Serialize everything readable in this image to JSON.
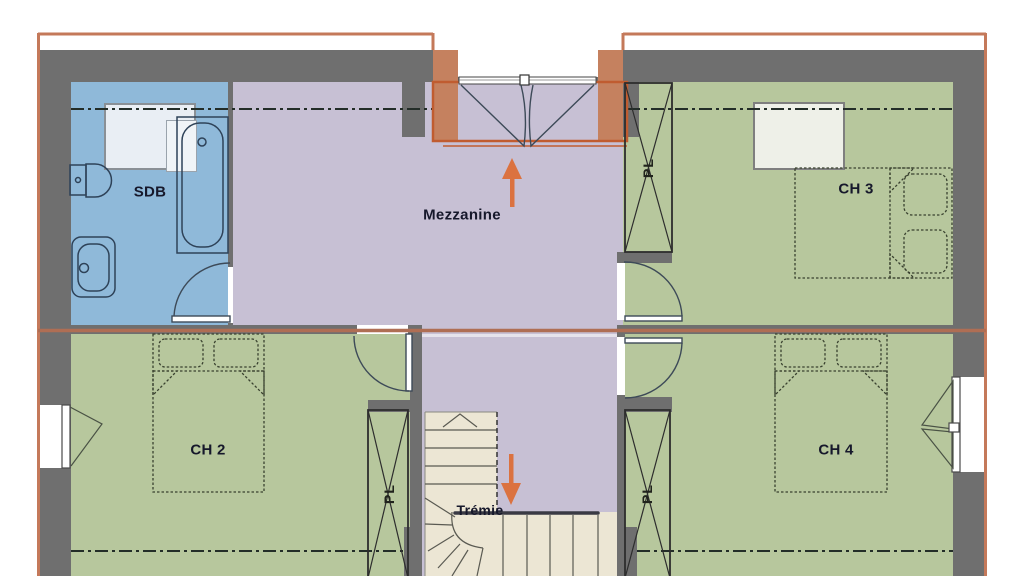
{
  "plan": {
    "type": "architectural-floor-plan-upper-storey",
    "labels": {
      "bathroom": "SDB",
      "mezzanine": "Mezzanine",
      "bedroom_2": "CH 2",
      "bedroom_3": "CH 3",
      "bedroom_4": "CH 4",
      "stair_opening": "Trémie",
      "closet": "PL"
    },
    "annotations": {
      "arrow_up": "up-arrow-into-mezzanine",
      "arrow_down": "down-arrow-to-stairs"
    },
    "colors": {
      "bathroom_fill": "#8fb9d9",
      "mezzanine_fill": "#c7c0d4",
      "bedroom_fill": "#b7c79d",
      "stairs_fill": "#ece6d4",
      "wall_fill": "#6f6f6f",
      "roof_outline": "#c4795a",
      "ridge_line": "#af6e54",
      "door_recess_fill": "#c5815f",
      "highlight_outline": "#c05c30",
      "arrow": "#db7240",
      "roof_window_fill": "#eef0e8",
      "axis_dashdot": "#232d28"
    }
  }
}
